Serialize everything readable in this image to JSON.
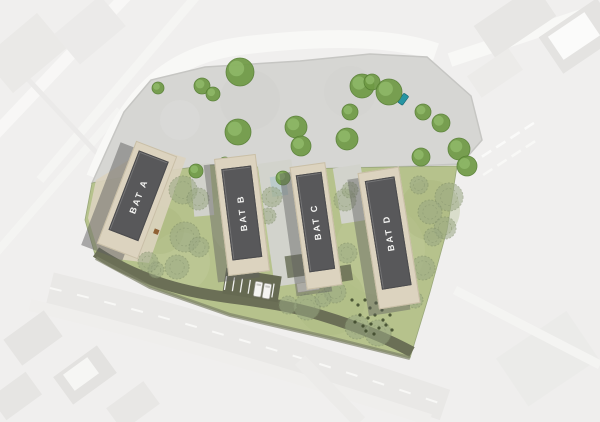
{
  "site": {
    "buildings": [
      {
        "label": "BAT A"
      },
      {
        "label": "BAT B"
      },
      {
        "label": "BAT C"
      },
      {
        "label": "BAT D"
      }
    ],
    "vehicles": {
      "white_vans": 2,
      "teal_car": 1
    },
    "palette": {
      "roof": "#58585a",
      "facade": "#dcd3bf",
      "lawn": "#b6c28c",
      "plaza": "#d6d6d3",
      "road": "#666a52",
      "tree_bright": "#6f9a45",
      "tree_sage": "#9aa883",
      "teal_vehicle": "#2795a3",
      "context_background": "#f0efee"
    }
  }
}
